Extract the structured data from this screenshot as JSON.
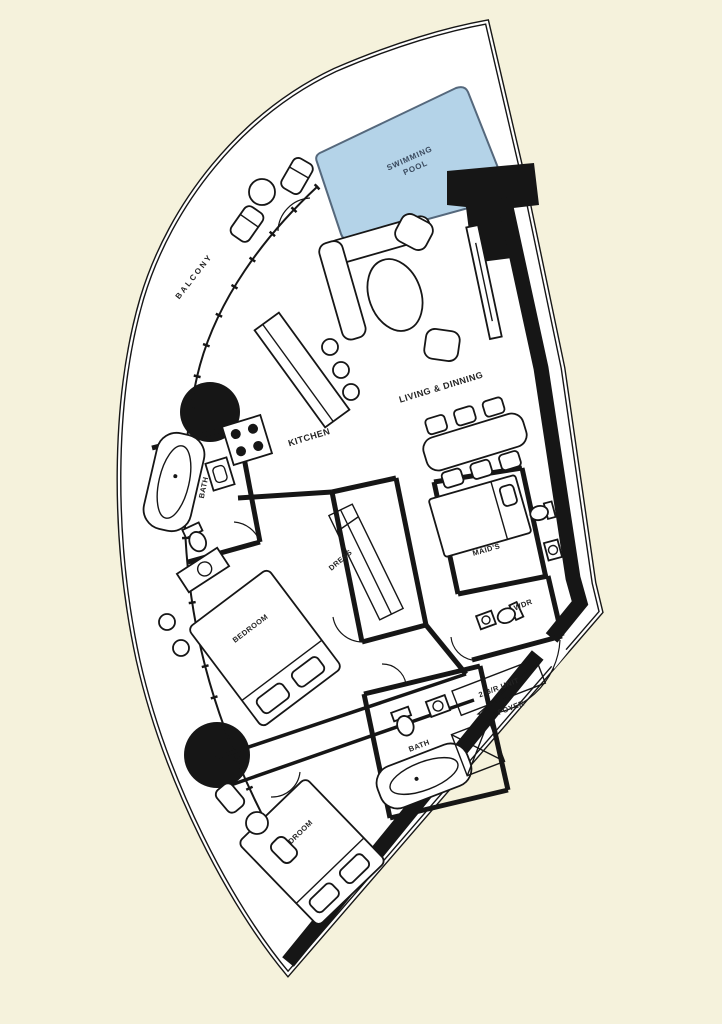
{
  "colors": {
    "bg": "#F5F2DC",
    "paper": "#FFFFFF",
    "ink": "#161616",
    "pool": "#B4D3E8",
    "pool-stroke": "#55687C",
    "pool-text": "#3A4A5E"
  },
  "plan": {
    "type": "apartment floor plan, fan-shaped 2-bedroom unit",
    "labels": {
      "pool_line1": "SWIMMING",
      "pool_line2": "POOL",
      "balcony": "BALCONY",
      "kitchen": "KITCHEN",
      "living_dining": "LIVING & DINNING",
      "bath_master": "BATH",
      "dress": "DRESS",
      "maids": "MAID'S",
      "bedroom_master": "BEDROOM",
      "wdr": "WDR",
      "unit_type": "2 B/R UNIT",
      "foyer": "FOYER",
      "bath_second": "BATH",
      "bedroom_second": "BEDROOM"
    }
  }
}
